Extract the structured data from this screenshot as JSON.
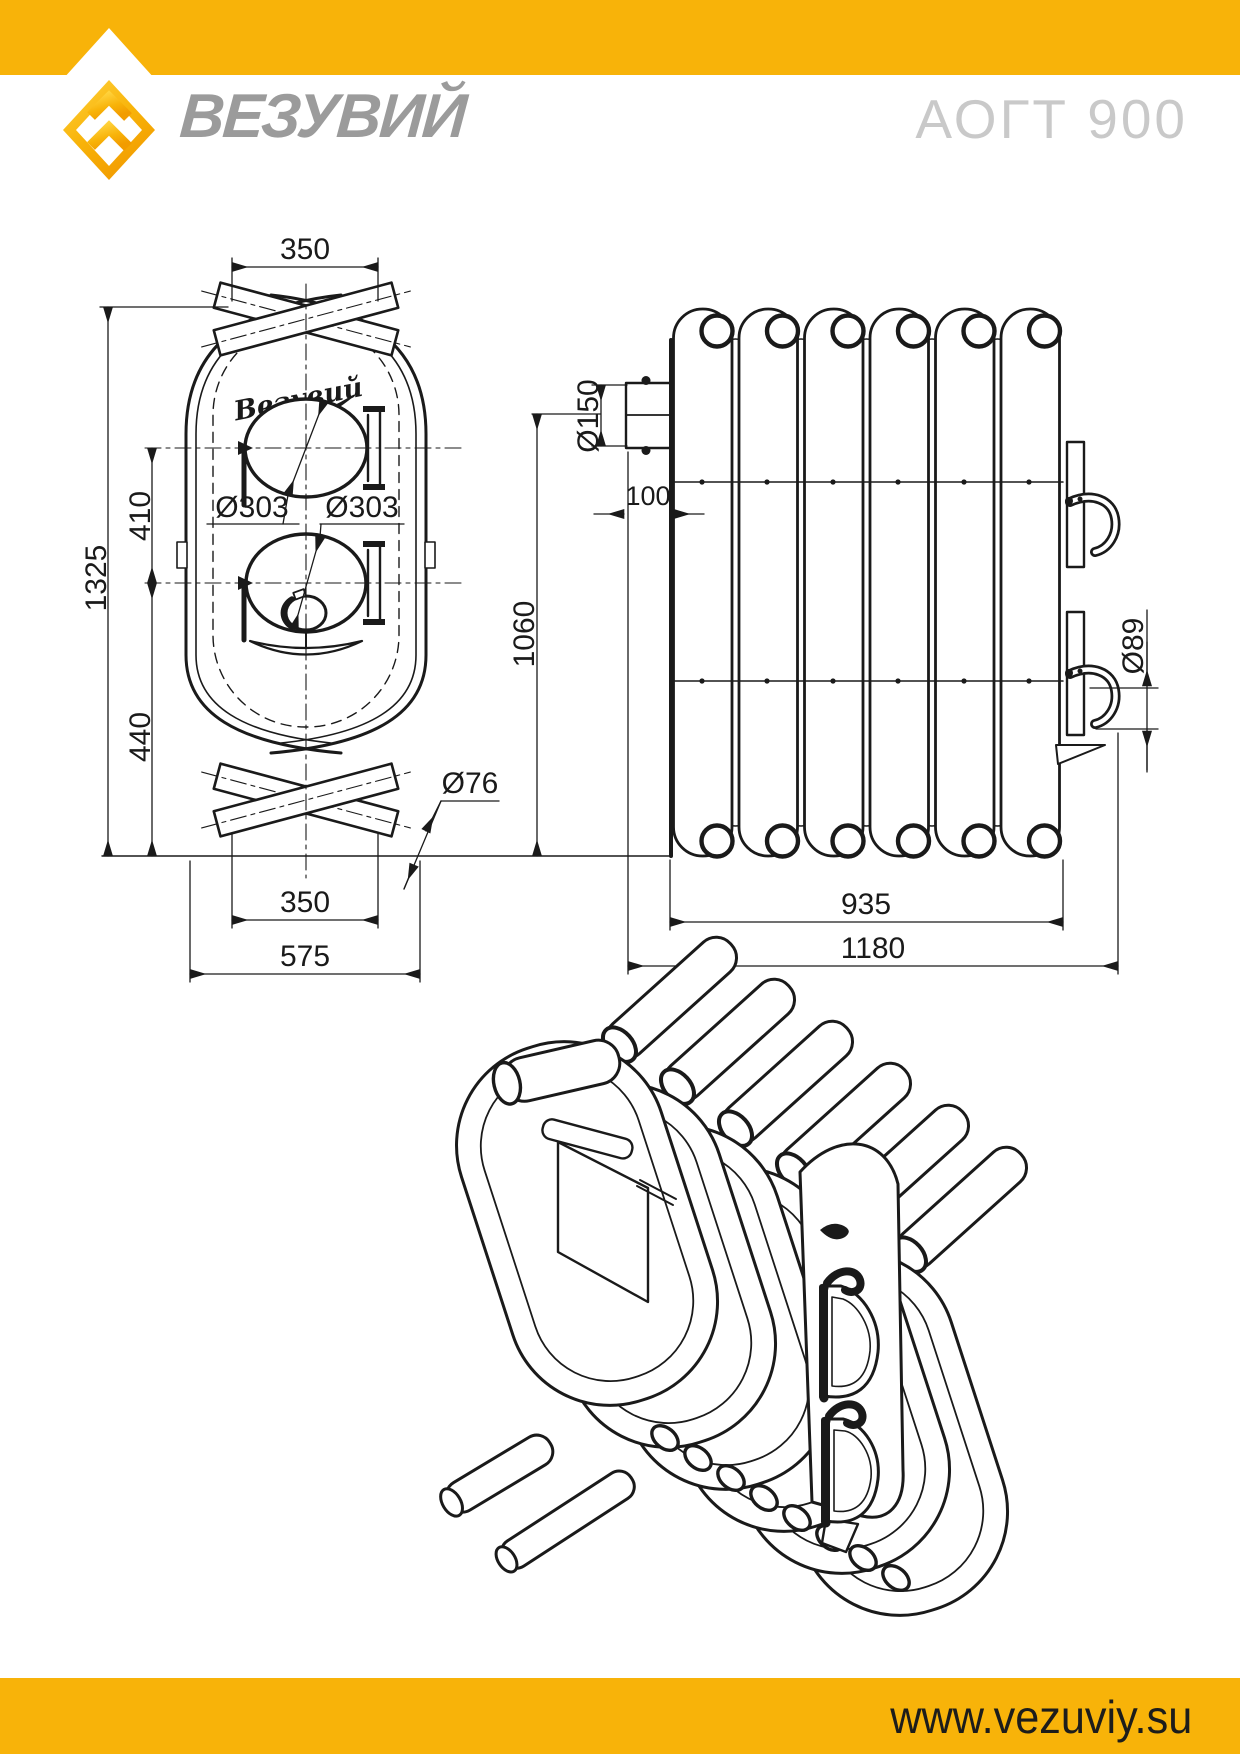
{
  "header": {
    "brand_name": "ВЕЗУВИЙ",
    "model": "АОГТ 900"
  },
  "footer": {
    "website": "www.vezuviy.su"
  },
  "colors": {
    "brand_yellow": "#F8B309",
    "logo_yellow_light": "#FFD23C",
    "logo_yellow_dark": "#F29C00",
    "brand_gray": "#9B9B9B",
    "model_gray": "#C9C9C9",
    "line_color": "#1a1a1a"
  },
  "front_view": {
    "script_badge": "Везувий",
    "dims": {
      "top_width": "350",
      "overall_height": "1325",
      "door_center_spacing": "410",
      "lower_section_height": "440",
      "upper_door_diameter": "Ø303",
      "lower_door_diameter": "Ø303",
      "pipe_diameter": "Ø76",
      "bottom_width": "350",
      "overall_width": "575"
    }
  },
  "side_view": {
    "dims": {
      "chimney_diameter": "Ø150",
      "chimney_offset": "100",
      "height": "1060",
      "handle_diameter": "Ø89",
      "tube_bundle_length": "935",
      "overall_length": "1180"
    }
  }
}
